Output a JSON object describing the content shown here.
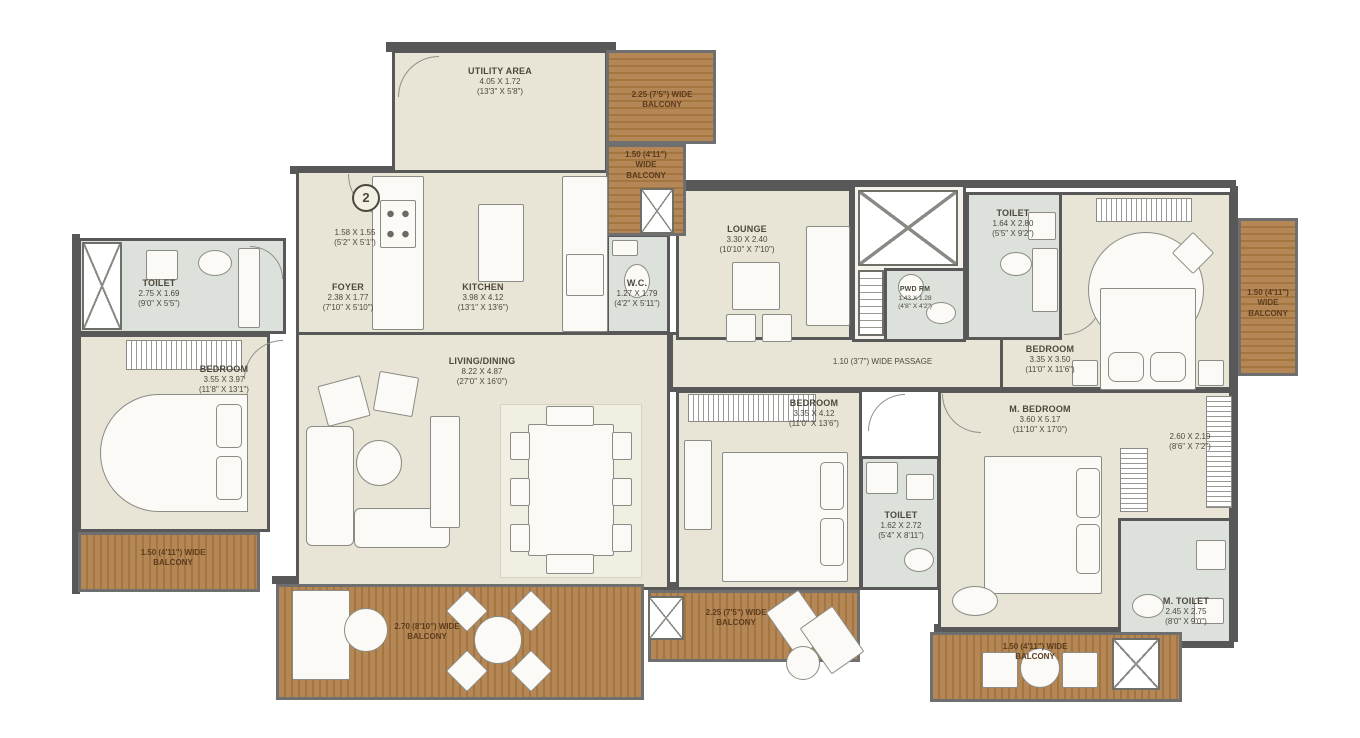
{
  "unit_marker": "2",
  "colors": {
    "wall": "#585858",
    "floor": "#e9e5d6",
    "bath_floor": "#dde1dc",
    "balcony_wood": "#b58756",
    "label_text": "#4c483c",
    "balcony_text": "#5b3c1e"
  },
  "rooms": {
    "utility": {
      "name": "UTILITY AREA",
      "dim_m": "4.05 X 1.72",
      "dim_ft": "(13'3\" X 5'8\")"
    },
    "entrance_lobby": {
      "dim_m": "1.58 X 1.55",
      "dim_ft": "(5'2\" X 5'1\")"
    },
    "foyer": {
      "name": "FOYER",
      "dim_m": "2.38 X 1.77",
      "dim_ft": "(7'10\" X 5'10\")"
    },
    "kitchen": {
      "name": "KITCHEN",
      "dim_m": "3.98 X 4.12",
      "dim_ft": "(13'1\" X 13'6\")"
    },
    "toilet_left": {
      "name": "TOILET",
      "dim_m": "2.75 X 1.69",
      "dim_ft": "(9'0\" X 5'5\")"
    },
    "bedroom_left": {
      "name": "BEDROOM",
      "dim_m": "3.55 X 3.97",
      "dim_ft": "(11'8\" X 13'1\")"
    },
    "living_dining": {
      "name": "LIVING/DINING",
      "dim_m": "8.22 X 4.87",
      "dim_ft": "(27'0\" X 16'0\")"
    },
    "wc": {
      "name": "W.C.",
      "dim_m": "1.27 X 1.79",
      "dim_ft": "(4'2\" X 5'11\")"
    },
    "lounge": {
      "name": "LOUNGE",
      "dim_m": "3.30 X 2.40",
      "dim_ft": "(10'10\" X 7'10\")"
    },
    "pwd_rm": {
      "name": "PWD RM",
      "dim_m": "1.43 X 1.28",
      "dim_ft": "(4'8\" X 4'2\")"
    },
    "toilet_top_right": {
      "name": "TOILET",
      "dim_m": "1.64 X 2.80",
      "dim_ft": "(5'5\" X 9'2\")"
    },
    "bedroom_right": {
      "name": "BEDROOM",
      "dim_m": "3.35 X 3.50",
      "dim_ft": "(11'0\" X 11'6\")"
    },
    "bedroom_middle": {
      "name": "BEDROOM",
      "dim_m": "3.35 X 4.12",
      "dim_ft": "(11'0\" X 13'6\")"
    },
    "m_bedroom": {
      "name": "M. BEDROOM",
      "dim_m": "3.60 X 5.17",
      "dim_ft": "(11'10\" X 17'0\")"
    },
    "dress_area": {
      "dim_m": "2.60 X 2.19",
      "dim_ft": "(8'6\" X 7'2\")"
    },
    "toilet_middle": {
      "name": "TOILET",
      "dim_m": "1.62 X 2.72",
      "dim_ft": "(5'4\" X 8'11\")"
    },
    "m_toilet": {
      "name": "M. TOILET",
      "dim_m": "2.45 X 2.75",
      "dim_ft": "(8'0\" X 9'0\")"
    }
  },
  "passage": {
    "label": "1.10 (3'7\") WIDE PASSAGE"
  },
  "balconies": {
    "top_upper": {
      "line1": "2.25 (7'5\") WIDE",
      "line2": "BALCONY"
    },
    "top_lower": {
      "line1": "1.50 (4'11\")",
      "line2": "WIDE",
      "line3": "BALCONY"
    },
    "right": {
      "line1": "1.50 (4'11\")",
      "line2": "WIDE",
      "line3": "BALCONY"
    },
    "left": {
      "line1": "1.50 (4'11\") WIDE",
      "line2": "BALCONY"
    },
    "bottom_left": {
      "line1": "2.70 (8'10\") WIDE",
      "line2": "BALCONY"
    },
    "bottom_center": {
      "line1": "2.25 (7'5\") WIDE",
      "line2": "BALCONY"
    },
    "bottom_right": {
      "line1": "1.50 (4'11\") WIDE",
      "line2": "BALCONY"
    }
  }
}
